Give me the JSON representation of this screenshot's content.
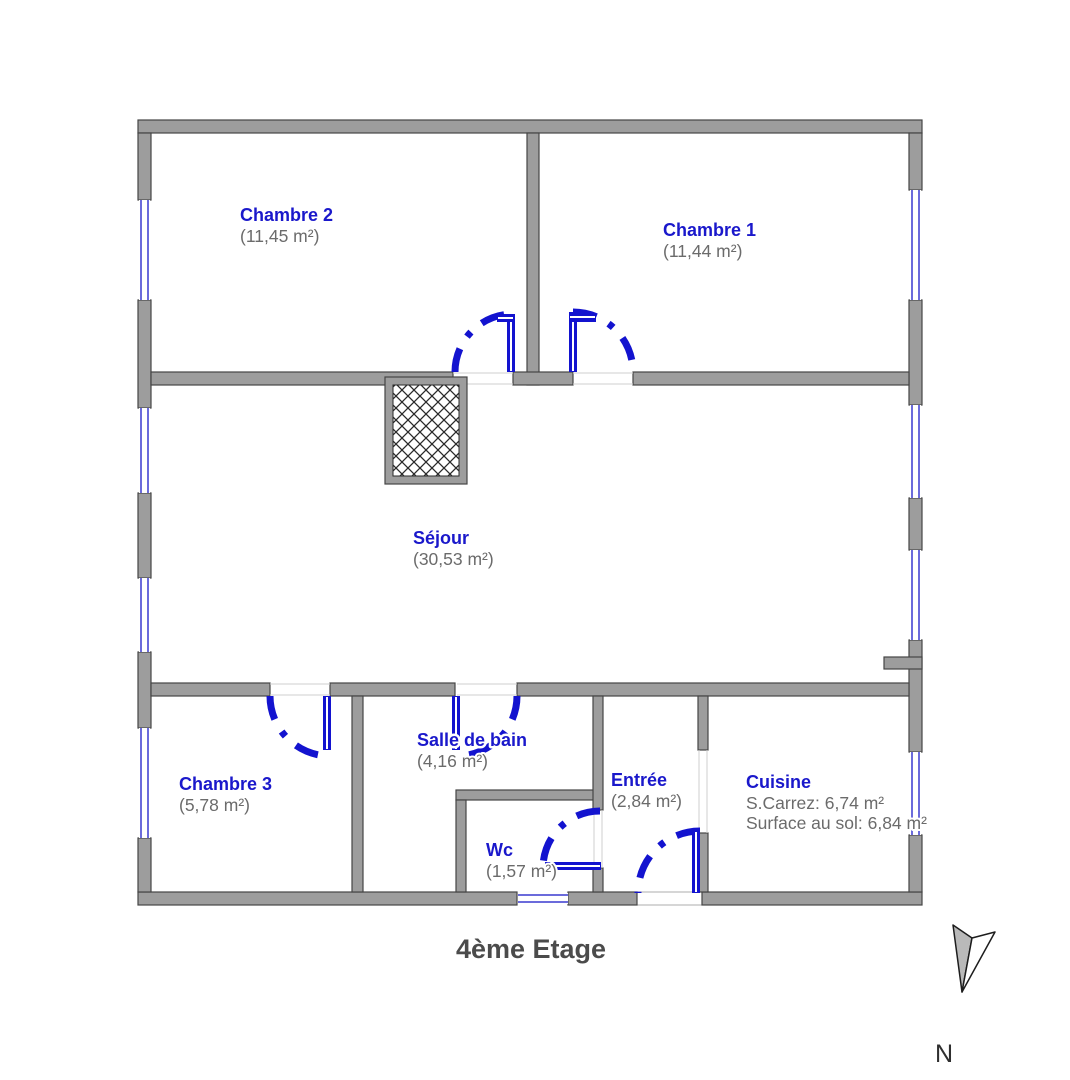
{
  "title": "4ème Etage",
  "compass": {
    "label": "N"
  },
  "colors": {
    "wall_fill": "#9d9d9d",
    "wall_stroke": "#454545",
    "door_blue": "#1313cf",
    "window_blue": "#6b6bdb",
    "label_blue": "#1a18cb",
    "area_gray": "#6b6b6b",
    "title_gray": "#4b4b4b",
    "threshold_gray": "#cfcfcf"
  },
  "rooms": [
    {
      "name": "Chambre 2",
      "area": "(11,45 m²)",
      "x": 240,
      "y": 221
    },
    {
      "name": "Chambre 1",
      "area": "(11,44 m²)",
      "x": 663,
      "y": 236
    },
    {
      "name": "Séjour",
      "area": "(30,53 m²)",
      "x": 413,
      "y": 544
    },
    {
      "name": "Chambre 3",
      "area": "(5,78 m²)",
      "x": 179,
      "y": 790
    },
    {
      "name": "Salle de bain",
      "area": "(4,16 m²)",
      "x": 417,
      "y": 746
    },
    {
      "name": "Entrée",
      "area": "(2,84 m²)",
      "x": 611,
      "y": 786
    },
    {
      "name": "Wc",
      "area": "(1,57 m²)",
      "x": 486,
      "y": 856
    },
    {
      "name": "Cuisine",
      "area": null,
      "lines": [
        "S.Carrez: 6,74 m²",
        "Surface au sol: 6,84 m²"
      ],
      "x": 746,
      "y": 788
    }
  ],
  "geometry": {
    "walls": [
      [
        138,
        120,
        784,
        13
      ],
      [
        138,
        892,
        379,
        13
      ],
      [
        568,
        892,
        69,
        13
      ],
      [
        702,
        892,
        220,
        13
      ],
      [
        138,
        133,
        13,
        67
      ],
      [
        138,
        300,
        13,
        108
      ],
      [
        138,
        493,
        13,
        85
      ],
      [
        138,
        652,
        13,
        76
      ],
      [
        138,
        838,
        13,
        54
      ],
      [
        909,
        133,
        13,
        57
      ],
      [
        909,
        300,
        13,
        105
      ],
      [
        909,
        498,
        13,
        52
      ],
      [
        909,
        640,
        13,
        112
      ],
      [
        909,
        835,
        13,
        57
      ],
      [
        884,
        657,
        38,
        12
      ],
      [
        527,
        133,
        12,
        252
      ],
      [
        151,
        372,
        302,
        13
      ],
      [
        513,
        372,
        60,
        13
      ],
      [
        633,
        372,
        276,
        13
      ],
      [
        151,
        683,
        119,
        13
      ],
      [
        330,
        683,
        125,
        13
      ],
      [
        517,
        683,
        392,
        13
      ],
      [
        352,
        696,
        11,
        196
      ],
      [
        456,
        790,
        141,
        10
      ],
      [
        456,
        800,
        10,
        92
      ],
      [
        593,
        696,
        10,
        114
      ],
      [
        593,
        868,
        10,
        24
      ],
      [
        698,
        696,
        10,
        54
      ],
      [
        698,
        833,
        10,
        59
      ]
    ],
    "windows": [
      {
        "x": 139,
        "y": 200,
        "w": 11,
        "h": 100,
        "o": "v"
      },
      {
        "x": 139,
        "y": 408,
        "w": 11,
        "h": 85,
        "o": "v"
      },
      {
        "x": 139,
        "y": 578,
        "w": 11,
        "h": 74,
        "o": "v"
      },
      {
        "x": 139,
        "y": 728,
        "w": 11,
        "h": 110,
        "o": "v"
      },
      {
        "x": 910,
        "y": 190,
        "w": 11,
        "h": 110,
        "o": "v"
      },
      {
        "x": 910,
        "y": 405,
        "w": 11,
        "h": 93,
        "o": "v"
      },
      {
        "x": 910,
        "y": 550,
        "w": 11,
        "h": 90,
        "o": "v"
      },
      {
        "x": 910,
        "y": 752,
        "w": 11,
        "h": 83,
        "o": "v"
      },
      {
        "x": 518,
        "y": 893,
        "w": 50,
        "h": 11,
        "o": "h"
      }
    ],
    "door_leaves": [
      [
        507,
        314,
        8,
        58
      ],
      [
        497,
        314,
        17,
        8
      ],
      [
        569,
        312,
        8,
        60
      ],
      [
        569,
        313,
        27,
        9
      ],
      [
        323,
        696,
        8,
        54
      ],
      [
        452,
        696,
        8,
        54
      ],
      [
        545,
        862,
        56,
        8
      ],
      [
        692,
        831,
        8,
        62
      ]
    ],
    "door_arcs": [
      "M455,372 A58,58 0 0 1 513,314",
      "M573,312 A60,60 0 0 1 633,372",
      "M270,696 A60,60 0 0 0 330,756",
      "M517,696 A60,60 0 0 1 457,756",
      "M600,811 A57,57 0 0 0 543,868",
      "M700,831 A62,62 0 0 0 638,893"
    ],
    "thresholds": [
      [
        453,
        373,
        513,
        373
      ],
      [
        453,
        384,
        513,
        384
      ],
      [
        573,
        373,
        633,
        373
      ],
      [
        573,
        384,
        633,
        384
      ],
      [
        270,
        684,
        330,
        684
      ],
      [
        270,
        695,
        330,
        695
      ],
      [
        457,
        684,
        517,
        684
      ],
      [
        457,
        695,
        517,
        695
      ],
      [
        594,
        810,
        594,
        868
      ],
      [
        602,
        810,
        602,
        868
      ],
      [
        699,
        750,
        699,
        833
      ],
      [
        707,
        750,
        707,
        833
      ]
    ],
    "entrance_opening": [
      637,
      892,
      65,
      13
    ],
    "shaft": {
      "outer": [
        385,
        377,
        82,
        107
      ],
      "inner": [
        393,
        385,
        66,
        91
      ]
    },
    "compass": {
      "filled_polygon": "953,925 972,938 962,992",
      "outline_polygon": "972,938 995,932 962,992",
      "label_x": 944,
      "label_y": 1062
    },
    "title_pos": {
      "x": 531,
      "y": 958
    }
  }
}
